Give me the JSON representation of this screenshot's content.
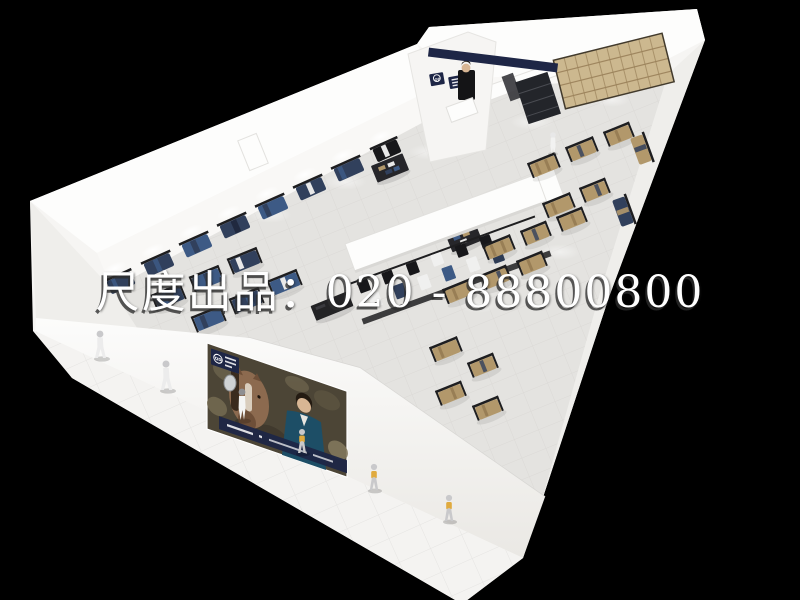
{
  "watermark": {
    "text": "尺度出品：020 - 88800800",
    "color": "#ffffff",
    "shadow_color": "#2d2d2d"
  },
  "branding": {
    "logo_text": "QD",
    "entrance_sign_color": "#1e2646",
    "poster_label_color": "#1d2a52"
  },
  "scene": {
    "subject": "menswear clothing store 3d aerial render",
    "storefront_poster": "man with horse fashion advertisement",
    "mannequins_outside": 6
  },
  "colors": {
    "background": "#000000",
    "watermark": "#ffffff",
    "wall": "#f6f5f3",
    "wall_bright": "#fdfdfc",
    "wall_face": "#f9f8f6",
    "wall_end": "#efeeeb",
    "floor": "#e4e3e0",
    "tile_line": "#d2d1ce",
    "sidewalk": "#f4f3f1",
    "sidewalk_line": "#e3e2df",
    "metal": "#1e1e20",
    "navy": "#31405c",
    "denim": "#3d5a85",
    "khaki": "#b2986b",
    "khaki_dark": "#8d744c",
    "wood": "#ccb88f",
    "wood_line": "#9a815a",
    "sign": "#1e2646",
    "poster_bg": "#4c4536",
    "suit": "#1d4e66",
    "horse": "#8c6a4f",
    "skin": "#d8b694",
    "silver": "#c9c9cb",
    "kid_accent": "#e0aa3e"
  }
}
